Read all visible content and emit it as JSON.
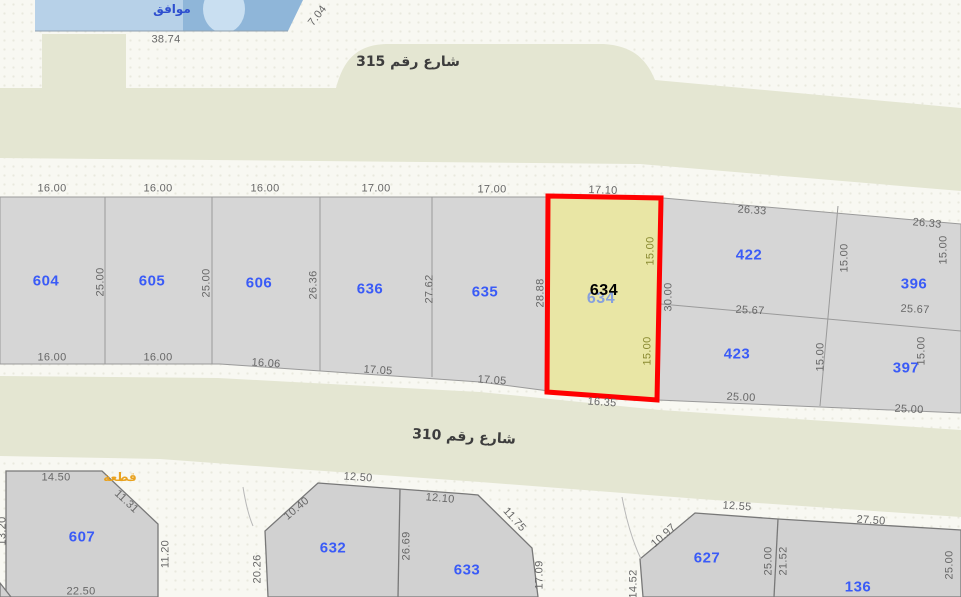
{
  "selection": {
    "parcel": "634"
  },
  "colors": {
    "street-beige": "#e4e6d2",
    "parcel-gray": "#d6d6d6",
    "parcel-gray-dark": "#d1d1d1",
    "parking-blue": "#8fb6d9",
    "highlight-red": "#ff0000",
    "highlight-fill": "#e9e6a5",
    "parcel-blue": "#3a5bf7"
  },
  "labels": [
    {
      "text": "موافق",
      "x": 172,
      "y": 9,
      "kind": "parking",
      "name": "parking-label"
    },
    {
      "text": "38.74",
      "x": 166,
      "y": 40,
      "kind": "dim"
    },
    {
      "text": "7.04",
      "x": 318,
      "y": 16,
      "rot": -52,
      "kind": "dim"
    },
    {
      "text": "شارع رقم 315",
      "x": 408,
      "y": 62,
      "kind": "street",
      "name": "street-315-label"
    },
    {
      "text": "شارع رقم 310",
      "x": 464,
      "y": 437,
      "rot": 3,
      "kind": "street",
      "name": "street-310-label"
    },
    {
      "text": "16.00",
      "x": 52,
      "y": 189,
      "kind": "dim"
    },
    {
      "text": "16.00",
      "x": 158,
      "y": 189,
      "kind": "dim"
    },
    {
      "text": "16.00",
      "x": 265,
      "y": 189,
      "kind": "dim"
    },
    {
      "text": "17.00",
      "x": 376,
      "y": 189,
      "kind": "dim"
    },
    {
      "text": "17.00",
      "x": 492,
      "y": 190,
      "kind": "dim"
    },
    {
      "text": "17.10",
      "x": 603,
      "y": 191,
      "rot": 2,
      "kind": "dim"
    },
    {
      "text": "604",
      "x": 46,
      "y": 281,
      "kind": "parcel"
    },
    {
      "text": "25.00",
      "x": 101,
      "y": 282,
      "rot": -90,
      "kind": "dim"
    },
    {
      "text": "605",
      "x": 152,
      "y": 281,
      "kind": "parcel"
    },
    {
      "text": "25.00",
      "x": 207,
      "y": 283,
      "rot": -90,
      "kind": "dim"
    },
    {
      "text": "606",
      "x": 259,
      "y": 283,
      "kind": "parcel"
    },
    {
      "text": "26.36",
      "x": 314,
      "y": 285,
      "rot": -90,
      "kind": "dim"
    },
    {
      "text": "636",
      "x": 370,
      "y": 289,
      "kind": "parcel"
    },
    {
      "text": "27.62",
      "x": 430,
      "y": 289,
      "rot": -90,
      "kind": "dim"
    },
    {
      "text": "635",
      "x": 485,
      "y": 292,
      "kind": "parcel"
    },
    {
      "text": "28.88",
      "x": 541,
      "y": 293,
      "rot": -90,
      "kind": "dim"
    },
    {
      "text": "16.00",
      "x": 52,
      "y": 358,
      "kind": "dim"
    },
    {
      "text": "16.00",
      "x": 158,
      "y": 358,
      "kind": "dim"
    },
    {
      "text": "16.06",
      "x": 266,
      "y": 364,
      "rot": 4,
      "kind": "dim"
    },
    {
      "text": "17.05",
      "x": 378,
      "y": 371,
      "rot": 4,
      "kind": "dim"
    },
    {
      "text": "17.05",
      "x": 492,
      "y": 381,
      "rot": 4,
      "kind": "dim"
    },
    {
      "text": "16.35",
      "x": 602,
      "y": 403,
      "rot": 4,
      "kind": "dim"
    },
    {
      "text": "634",
      "x": 601,
      "y": 299,
      "kind": "ghost",
      "name": "parcel-634-ghost-label"
    },
    {
      "text": "634",
      "x": 604,
      "y": 291,
      "kind": "hl",
      "name": "parcel-634-highlight-label"
    },
    {
      "text": "15.00",
      "x": 651,
      "y": 251,
      "rot": -90,
      "kind": "dim olive"
    },
    {
      "text": "15.00",
      "x": 648,
      "y": 351,
      "rot": -90,
      "kind": "dim olive"
    },
    {
      "text": "30.00",
      "x": 669,
      "y": 297,
      "rot": -90,
      "kind": "dim"
    },
    {
      "text": "26.33",
      "x": 752,
      "y": 211,
      "rot": 4,
      "kind": "dim"
    },
    {
      "text": "26.33",
      "x": 927,
      "y": 224,
      "rot": 5,
      "kind": "dim"
    },
    {
      "text": "422",
      "x": 749,
      "y": 255,
      "kind": "parcel"
    },
    {
      "text": "15.00",
      "x": 845,
      "y": 258,
      "rot": -90,
      "kind": "dim"
    },
    {
      "text": "15.00",
      "x": 944,
      "y": 250,
      "rot": -90,
      "kind": "dim"
    },
    {
      "text": "396",
      "x": 914,
      "y": 284,
      "kind": "parcel"
    },
    {
      "text": "25.67",
      "x": 750,
      "y": 311,
      "rot": 3,
      "kind": "dim"
    },
    {
      "text": "25.67",
      "x": 915,
      "y": 310,
      "rot": 3,
      "kind": "dim"
    },
    {
      "text": "423",
      "x": 737,
      "y": 354,
      "kind": "parcel"
    },
    {
      "text": "15.00",
      "x": 821,
      "y": 357,
      "rot": -90,
      "kind": "dim"
    },
    {
      "text": "397",
      "x": 906,
      "y": 368,
      "kind": "parcel"
    },
    {
      "text": "15.00",
      "x": 922,
      "y": 351,
      "rot": -90,
      "kind": "dim"
    },
    {
      "text": "25.00",
      "x": 741,
      "y": 398,
      "rot": 3,
      "kind": "dim"
    },
    {
      "text": "25.00",
      "x": 909,
      "y": 410,
      "rot": 3,
      "kind": "dim"
    },
    {
      "text": "قطعة",
      "x": 120,
      "y": 477,
      "kind": "orange",
      "name": "plot-orange-label"
    },
    {
      "text": "14.50",
      "x": 56,
      "y": 478,
      "kind": "dim"
    },
    {
      "text": "11.31",
      "x": 126,
      "y": 502,
      "rot": 43,
      "kind": "dim"
    },
    {
      "text": "607",
      "x": 82,
      "y": 537,
      "kind": "parcel"
    },
    {
      "text": "13.20",
      "x": 3,
      "y": 531,
      "rot": -90,
      "kind": "dim"
    },
    {
      "text": "11.20",
      "x": 166,
      "y": 554,
      "rot": -90,
      "kind": "dim"
    },
    {
      "text": "22.50",
      "x": 81,
      "y": 592,
      "kind": "dim"
    },
    {
      "text": "12.50",
      "x": 358,
      "y": 478,
      "rot": 4,
      "kind": "dim"
    },
    {
      "text": "10.40",
      "x": 297,
      "y": 509,
      "rot": -40,
      "kind": "dim"
    },
    {
      "text": "20.26",
      "x": 258,
      "y": 569,
      "rot": -90,
      "kind": "dim"
    },
    {
      "text": "632",
      "x": 333,
      "y": 548,
      "kind": "parcel"
    },
    {
      "text": "26.69",
      "x": 407,
      "y": 546,
      "rot": -90,
      "kind": "dim"
    },
    {
      "text": "12.10",
      "x": 440,
      "y": 499,
      "rot": 5,
      "kind": "dim"
    },
    {
      "text": "11.75",
      "x": 514,
      "y": 520,
      "rot": 48,
      "kind": "dim"
    },
    {
      "text": "633",
      "x": 467,
      "y": 570,
      "kind": "parcel"
    },
    {
      "text": "17.09",
      "x": 540,
      "y": 575,
      "rot": -90,
      "kind": "dim"
    },
    {
      "text": "12.55",
      "x": 737,
      "y": 507,
      "rot": 4,
      "kind": "dim"
    },
    {
      "text": "10.97",
      "x": 664,
      "y": 536,
      "rot": -42,
      "kind": "dim"
    },
    {
      "text": "14.52",
      "x": 634,
      "y": 584,
      "rot": -90,
      "kind": "dim"
    },
    {
      "text": "627",
      "x": 707,
      "y": 558,
      "kind": "parcel"
    },
    {
      "text": "25.00",
      "x": 769,
      "y": 561,
      "rot": -90,
      "kind": "dim"
    },
    {
      "text": "21.52",
      "x": 784,
      "y": 561,
      "rot": -90,
      "kind": "dim"
    },
    {
      "text": "27.50",
      "x": 871,
      "y": 521,
      "rot": 4,
      "kind": "dim"
    },
    {
      "text": "136",
      "x": 858,
      "y": 587,
      "kind": "parcel"
    },
    {
      "text": "25.00",
      "x": 950,
      "y": 565,
      "rot": -90,
      "kind": "dim"
    }
  ]
}
